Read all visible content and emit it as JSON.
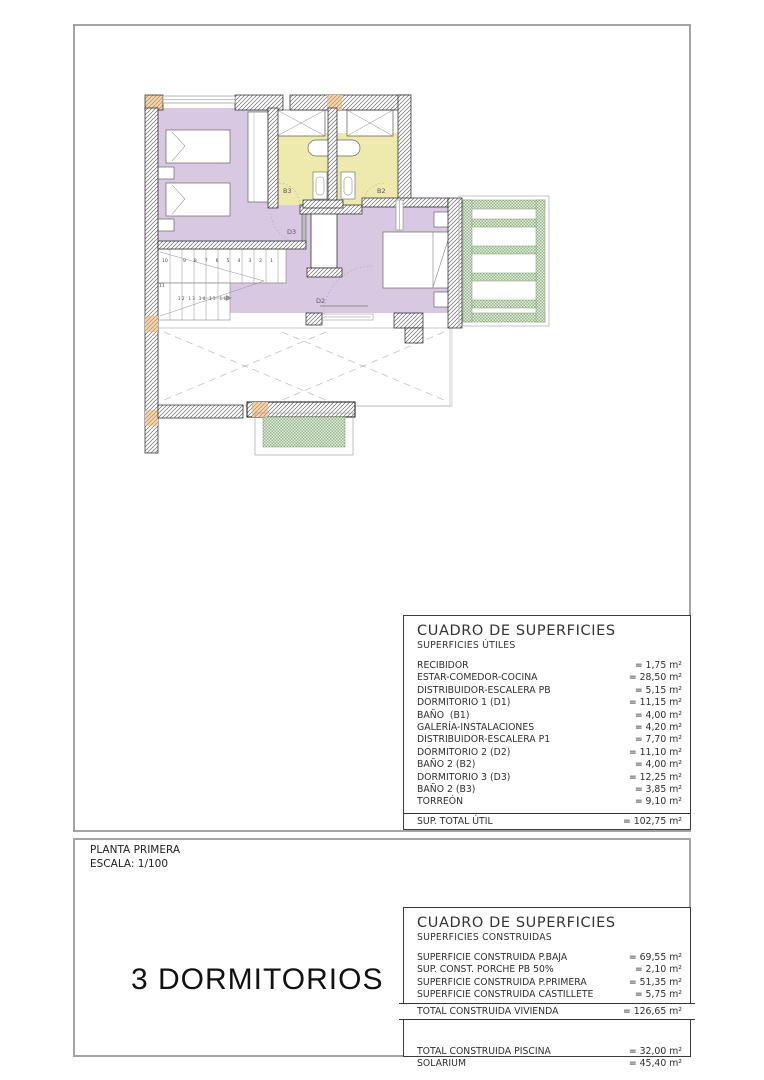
{
  "plan": {
    "labels": {
      "b3": "B3",
      "b2": "B2",
      "d3": "D3",
      "d2": "D2"
    },
    "stairs": {
      "turn": "10",
      "top_row": "9 8 7 6 5 4 3 2 1",
      "landing": "11",
      "bottom_row": "12 13 14 15 16"
    }
  },
  "title_block": {
    "floor": "PLANTA PRIMERA",
    "scale": "ESCALA: 1/100",
    "bedrooms": "3 DORMITORIOS"
  },
  "surfaces_table": {
    "title": "CUADRO DE SUPERFICIES",
    "subtitle": "SUPERFICIES ÚTILES",
    "rows": [
      {
        "label": "RECIBIDOR",
        "value": "= 1,75 m²"
      },
      {
        "label": "ESTAR-COMEDOR-COCINA",
        "value": "= 28,50 m²"
      },
      {
        "label": "DISTRIBUIDOR-ESCALERA PB",
        "value": "= 5,15 m²"
      },
      {
        "label": "DORMITORIO 1 (D1)",
        "value": "= 11,15 m²"
      },
      {
        "label": "BAÑO  (B1)",
        "value": "= 4,00 m²"
      },
      {
        "label": "GALERÍA-INSTALACIONES",
        "value": "= 4,20 m²"
      },
      {
        "label": "DISTRIBUIDOR-ESCALERA P1",
        "value": "= 7,70 m²"
      },
      {
        "label": "DORMITORIO 2 (D2)",
        "value": "= 11,10 m²"
      },
      {
        "label": "BAÑO 2 (B2)",
        "value": "= 4,00 m²"
      },
      {
        "label": "DORMITORIO 3 (D3)",
        "value": "= 12,25 m²"
      },
      {
        "label": "BAÑO 2 (B3)",
        "value": "= 3,85 m²"
      },
      {
        "label": "TORREÓN",
        "value": "= 9,10 m²"
      }
    ],
    "total_label": "SUP. TOTAL ÚTIL",
    "total_value": "= 102,75 m²"
  },
  "construction_table": {
    "title": "CUADRO DE SUPERFICIES",
    "subtitle": "SUPERFICIES CONSTRUIDAS",
    "rows": [
      {
        "label": "SUPERFICIE CONSTRUIDA P.BAJA",
        "value": "= 69,55 m²"
      },
      {
        "label": "SUP. CONST. PORCHE PB 50%",
        "value": "= 2,10 m²"
      },
      {
        "label": "SUPERFICIE CONSTRUIDA P.PRIMERA",
        "value": "= 51,35 m²"
      },
      {
        "label": "SUPERFICIE CONSTRUIDA CASTILLETE",
        "value": "= 5,75 m²"
      }
    ],
    "total_label": "TOTAL CONSTRUIDA VIVIENDA",
    "total_value": "= 126,65 m²",
    "extra_rows": [
      {
        "label": "TOTAL CONSTRUIDA PISCINA",
        "value": "= 32,00 m²"
      },
      {
        "label": "SOLARIUM",
        "value": "= 45,40 m²"
      }
    ]
  },
  "colors": {
    "room_purple": "#d9c8e2",
    "room_yellow": "#eeeaad",
    "pergola_green": "#94b48a",
    "wall_orange": "#c3854a",
    "frame_gray": "#a3a3a3"
  }
}
